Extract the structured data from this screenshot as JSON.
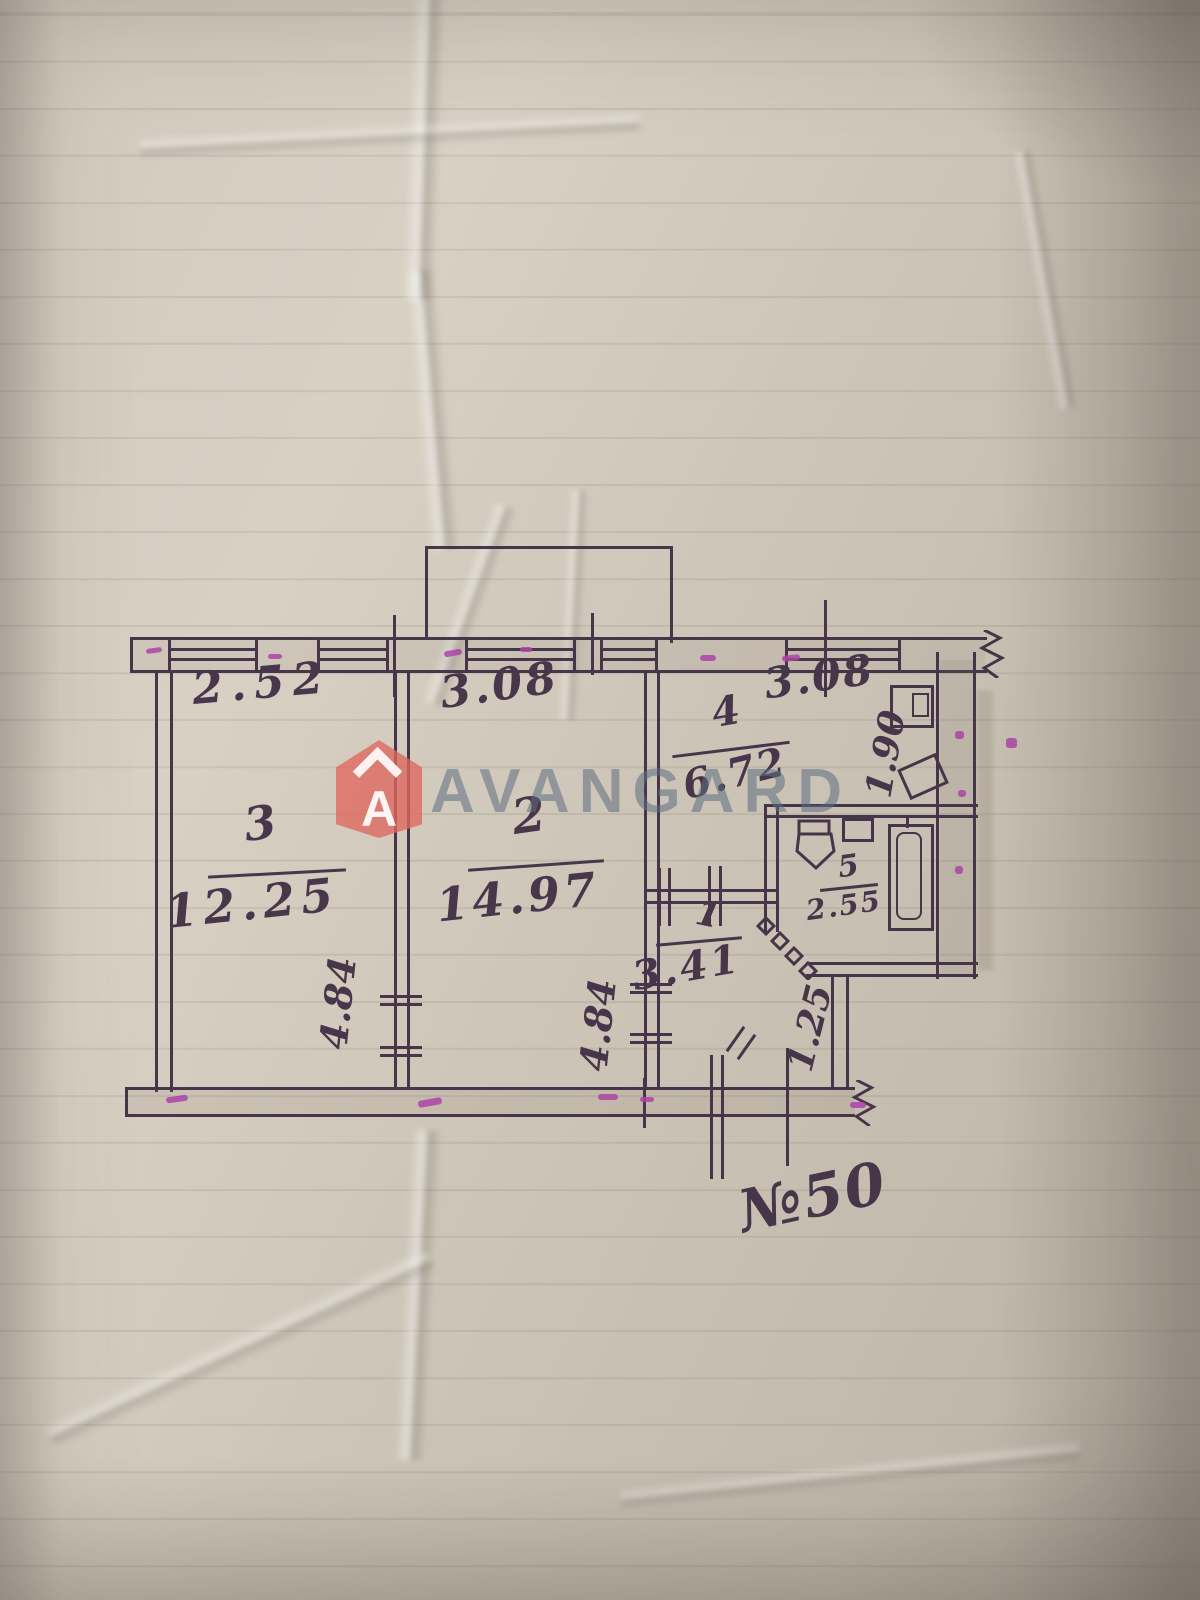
{
  "photo": {
    "paper_color": "#cfc7ba",
    "ink_color": "#3d2b41",
    "marker_color": "#ac3aa8"
  },
  "watermark": {
    "text": "AVANGARD",
    "logo_letter": "A",
    "text_color": "#5c6e80",
    "logo_color": "#e1695f"
  },
  "floor_plan": {
    "plan_number": "№50",
    "rooms": {
      "r1": {
        "number": "1",
        "area": "3.41",
        "width": "1.25"
      },
      "r2": {
        "number": "2",
        "area": "14.97",
        "width": "3.08",
        "depth": "4.84"
      },
      "r3": {
        "number": "3",
        "area": "12.25",
        "width": "2.52",
        "depth": "4.84"
      },
      "r4": {
        "number": "4",
        "area": "6.72",
        "width": "3.08",
        "depth": "1.90"
      },
      "r5": {
        "number": "5",
        "area": "2.55"
      }
    }
  }
}
